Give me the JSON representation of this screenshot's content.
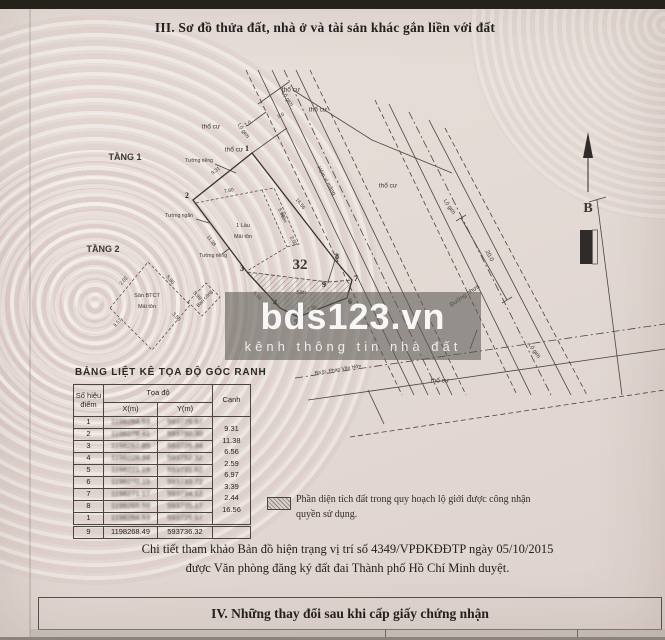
{
  "page": {
    "section3_title": "III. Sơ đồ thửa đất, nhà ở và tài sản khác gắn liền với đất",
    "section4_title": "IV. Những thay đổi sau khi cấp giấy chứng nhận",
    "footer_note_line1": "Chi tiết tham khảo Bản đồ hiện trạng vị trí số 4349/VPĐKĐĐTP  ngày 05/10/2015",
    "footer_note_line2": "được Văn phòng đăng ký đất đai Thành phố Hồ Chí Minh duyệt."
  },
  "watermark": {
    "brand": "bds123.vn",
    "tagline": "kênh thông tin nhà đất",
    "box_color": "#5c5955"
  },
  "legend": {
    "line1": "Phần diện tích đất trong quy hoạch lộ giới được công nhận",
    "line2": "quyền sử dụng."
  },
  "table": {
    "title": "BẢNG LIỆT KÊ TỌA ĐỘ GÓC RANH",
    "col_point_line1": "Số hiệu",
    "col_point_line2": "điểm",
    "col_coords": "Tọa độ",
    "col_x": "X(m)",
    "col_y": "Y(m)",
    "col_edge": "Cạnh",
    "rows": [
      {
        "point": "1",
        "x": "1198284.53",
        "y": "593775.87"
      },
      {
        "point": "2",
        "x": "1198278.41",
        "y": "593780.30"
      },
      {
        "point": "3",
        "x": "1198267.85",
        "y": "593726.34"
      },
      {
        "point": "4",
        "x": "1198228.34",
        "y": "593752.32"
      },
      {
        "point": "5",
        "x": "1198221.19",
        "y": "593731.62"
      },
      {
        "point": "6",
        "x": "1198270.15",
        "y": "593733.72"
      },
      {
        "point": "7",
        "x": "1198271.17",
        "y": "593734.12"
      },
      {
        "point": "8",
        "x": "1198265.59",
        "y": "593735.17"
      },
      {
        "point": "1",
        "x": "1198284.53",
        "y": "593725.67"
      }
    ],
    "edges": [
      "9.31",
      "11.38",
      "6.56",
      "2.59",
      "6.97",
      "3.39",
      "2.44",
      "16.56"
    ],
    "footer_row": {
      "point": "9",
      "x": "1198268.49",
      "y": "593736.32"
    }
  },
  "diagram": {
    "plot_number": "32",
    "north_label": "B",
    "labels": [
      {
        "text": "TẦNG 1",
        "x": 125,
        "y": 158,
        "fs": 9,
        "bold": true
      },
      {
        "text": "TẦNG 2",
        "x": 103,
        "y": 250,
        "fs": 9,
        "bold": true
      },
      {
        "text": "32",
        "x": 300,
        "y": 266,
        "fs": 15,
        "bold": true,
        "serif": true
      },
      {
        "text": "B",
        "x": 588,
        "y": 209,
        "fs": 14,
        "bold": true,
        "serif": true
      },
      {
        "text": "thổ cư",
        "x": 291,
        "y": 90,
        "fs": 6.5
      },
      {
        "text": "thổ cư",
        "x": 318,
        "y": 110,
        "fs": 6.5
      },
      {
        "text": "thổ cư",
        "x": 211,
        "y": 127,
        "fs": 6.5
      },
      {
        "text": "thổ cư",
        "x": 234,
        "y": 150,
        "fs": 6.5
      },
      {
        "text": "thổ cư",
        "x": 388,
        "y": 186,
        "fs": 6.5
      },
      {
        "text": "thổ cư",
        "x": 440,
        "y": 381,
        "fs": 6.5
      },
      {
        "text": "Lộ giới",
        "x": 287,
        "y": 99,
        "rot": 56,
        "fs": 5.5
      },
      {
        "text": "Lộ giới",
        "x": 243,
        "y": 131,
        "rot": 56,
        "fs": 5.5
      },
      {
        "text": "Lộ giới",
        "x": 449,
        "y": 207,
        "rot": 56,
        "fs": 5.5
      },
      {
        "text": "Lộ giới",
        "x": 534,
        "y": 351,
        "rot": 56,
        "fs": 5.5
      },
      {
        "text": "Hẻm xi măng",
        "x": 326,
        "y": 181,
        "rot": 60,
        "fs": 5.5
      },
      {
        "text": "Đường nhựa",
        "x": 465,
        "y": 296,
        "rot": -35,
        "fs": 6
      },
      {
        "text": "Ra Đ. Phan Văn Hớn",
        "x": 338,
        "y": 370,
        "rot": -9,
        "fs": 5
      },
      {
        "text": "20.0",
        "x": 489,
        "y": 256,
        "rot": 62,
        "fs": 6
      },
      {
        "text": "Tường riêng",
        "x": 199,
        "y": 161,
        "fs": 5
      },
      {
        "text": "Tường ngăn",
        "x": 179,
        "y": 216,
        "fs": 5
      },
      {
        "text": "Tường riêng",
        "x": 213,
        "y": 256,
        "fs": 5
      },
      {
        "text": "1 Lầu",
        "x": 243,
        "y": 226,
        "fs": 5.5
      },
      {
        "text": "Mái tôn",
        "x": 243,
        "y": 237,
        "fs": 5.5
      },
      {
        "text": "Sân BTCT",
        "x": 147,
        "y": 296,
        "fs": 5.5
      },
      {
        "text": "Mái tôn",
        "x": 147,
        "y": 307,
        "fs": 5.5
      },
      {
        "text": "Ban công",
        "x": 205,
        "y": 299,
        "rot": -47,
        "fs": 5
      },
      {
        "text": "Hiên",
        "x": 283,
        "y": 218,
        "rot": 64,
        "fs": 5
      },
      {
        "text": "Sân",
        "x": 301,
        "y": 293,
        "fs": 5.5
      },
      {
        "text": "9.31",
        "x": 216,
        "y": 171,
        "rot": -39,
        "fs": 5
      },
      {
        "text": "7.80",
        "x": 229,
        "y": 191,
        "rot": -11,
        "fs": 5
      },
      {
        "text": "5.90",
        "x": 281,
        "y": 213,
        "rot": 64,
        "fs": 5
      },
      {
        "text": "2.50",
        "x": 293,
        "y": 241,
        "rot": 64,
        "fs": 5
      },
      {
        "text": "11.38",
        "x": 211,
        "y": 241,
        "rot": 53,
        "fs": 5
      },
      {
        "text": "16.56",
        "x": 300,
        "y": 204,
        "rot": 52,
        "fs": 5
      },
      {
        "text": "6.56",
        "x": 257,
        "y": 296,
        "rot": 47,
        "fs": 5
      },
      {
        "text": "7.35",
        "x": 312,
        "y": 309,
        "rot": -21,
        "fs": 5
      },
      {
        "text": "2.02",
        "x": 124,
        "y": 281,
        "rot": -49,
        "fs": 5
      },
      {
        "text": "5.90",
        "x": 170,
        "y": 280,
        "rot": 49,
        "fs": 5
      },
      {
        "text": "5.99",
        "x": 197,
        "y": 296,
        "rot": 49,
        "fs": 5
      },
      {
        "text": "3.50",
        "x": 176,
        "y": 317,
        "rot": 49,
        "fs": 5
      },
      {
        "text": "9.57",
        "x": 118,
        "y": 323,
        "rot": -49,
        "fs": 5
      },
      {
        "text": "3.0",
        "x": 281,
        "y": 116,
        "rot": -28,
        "fs": 5
      },
      {
        "text": "1.0",
        "x": 248,
        "y": 124,
        "rot": -28,
        "fs": 5
      }
    ],
    "points": [
      {
        "n": "1",
        "x": 247,
        "y": 149
      },
      {
        "n": "2",
        "x": 187,
        "y": 196
      },
      {
        "n": "3",
        "x": 242,
        "y": 269
      },
      {
        "n": "4",
        "x": 275,
        "y": 303
      },
      {
        "n": "5",
        "x": 296,
        "y": 323
      },
      {
        "n": "6",
        "x": 350,
        "y": 302
      },
      {
        "n": "7",
        "x": 356,
        "y": 279
      },
      {
        "n": "8",
        "x": 337,
        "y": 257
      },
      {
        "n": "9",
        "x": 324,
        "y": 285
      }
    ]
  }
}
